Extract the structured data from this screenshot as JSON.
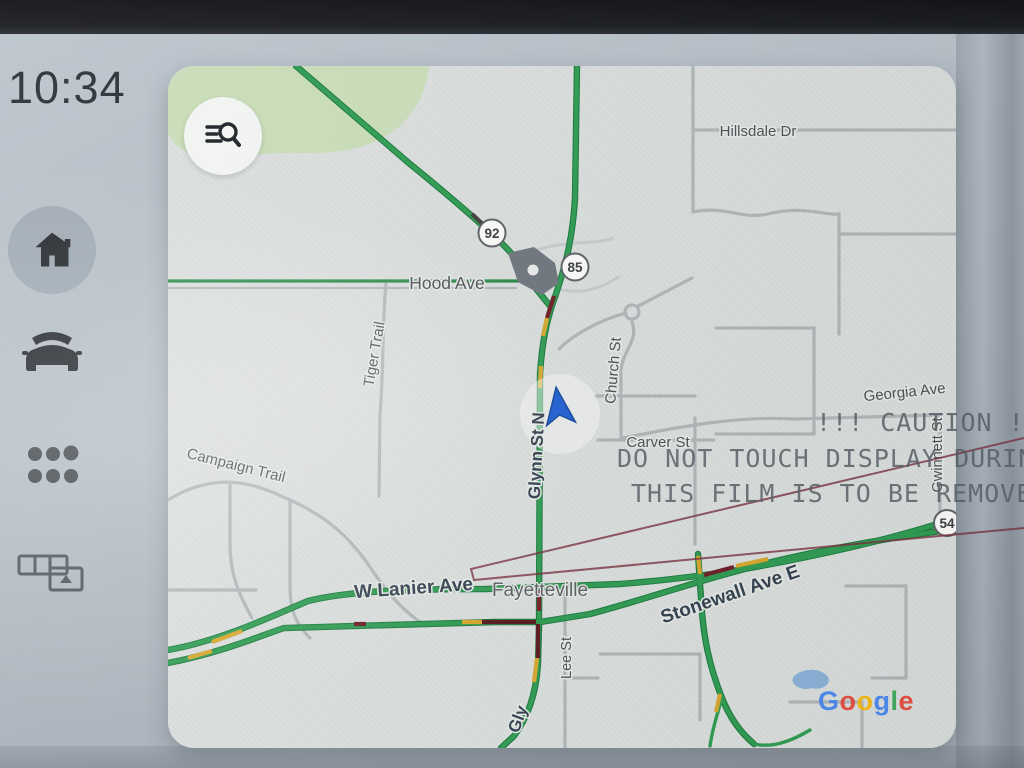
{
  "statusbar": {
    "time": "10:34"
  },
  "sidebar": {
    "buttons": [
      {
        "id": "home",
        "icon": "home-icon"
      },
      {
        "id": "vehicle",
        "icon": "car-icon"
      },
      {
        "id": "apps",
        "icon": "app-grid-icon"
      },
      {
        "id": "split-screen",
        "icon": "split-screen-icon"
      }
    ]
  },
  "map": {
    "provider": "Google",
    "labels": {
      "hillsdale": "Hillsdale Dr",
      "hood": "Hood Ave",
      "tiger": "Tiger Trail",
      "campaign": "Campaign Trail",
      "church": "Church St",
      "carver": "Carver St",
      "georgia": "Georgia Ave",
      "gwinnett": "Gwinnett St",
      "glynn": "Glynn St N",
      "glynn_partial": "Gly",
      "lee": "Lee St",
      "lanier": "W Lanier Ave",
      "stonewall": "Stonewall Ave E",
      "city": "Fayetteville"
    },
    "shields": {
      "sr92": "92",
      "i85": "85",
      "sr54": "54"
    },
    "google_letters": [
      "G",
      "o",
      "o",
      "g",
      "l",
      "e"
    ]
  },
  "film_warning": {
    "line1": "!!! CAUTION !!",
    "line2": "DO NOT TOUCH DISPLAY DURING",
    "line3": "THIS FILM IS TO BE REMOVED"
  },
  "colors": {
    "traffic_green": "#2f9d52",
    "traffic_yellow": "#d9a82e",
    "traffic_red": "#7a222b",
    "navigation_arrow": "#2160d4",
    "film_line": "#7b3240",
    "google_blue": "#4285F4",
    "google_red": "#EA4335",
    "google_yellow": "#FBBC05",
    "google_green": "#34A853"
  }
}
